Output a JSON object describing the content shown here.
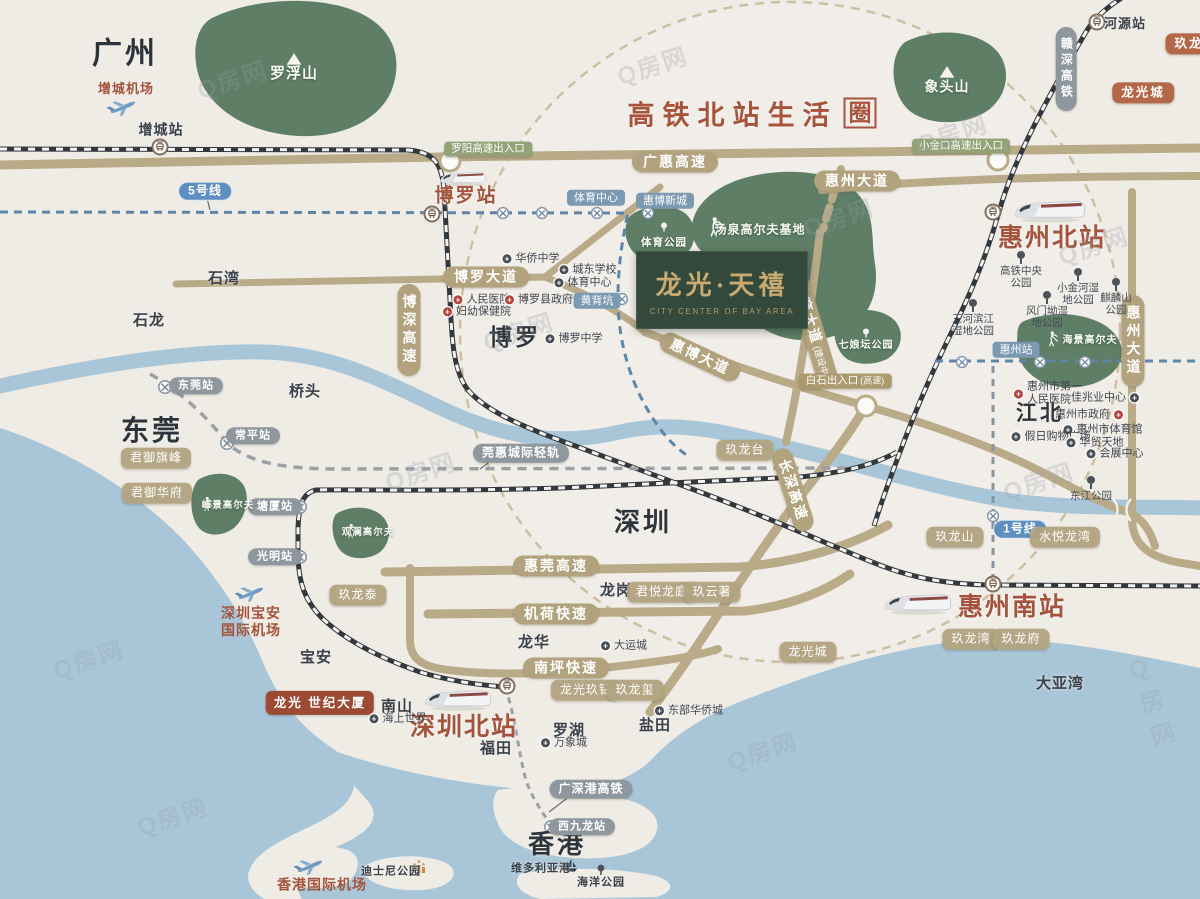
{
  "watermark": {
    "text": "Q房网"
  },
  "title": {
    "main": "高铁北站生活",
    "boxed": "圈"
  },
  "logo": {
    "cn": "龙光·天禧",
    "en": "CITY CENTER OF BAY AREA"
  },
  "colors": {
    "background": "#efece6",
    "water": "#a9c6d8",
    "green_area": "#5e7e66",
    "road": "#b9ab88",
    "railway": "#33383d",
    "metro_line": "#5d86a8",
    "brand_brown": "#a4543c",
    "logo_bg": "#32493c",
    "logo_gold": "#c9ab72",
    "tag_tan": "#b2a37e",
    "tag_orange": "#b4684a",
    "tag_blue": "#7b9ab2",
    "tag_green": "#94a377",
    "tag_darkred": "#9c4a33"
  },
  "labels": [
    {
      "text": "广州",
      "x": 125,
      "y": 55,
      "c": "city",
      "s": 30,
      "n": "city-guangzhou"
    },
    {
      "text": "东莞",
      "x": 152,
      "y": 431,
      "c": "city",
      "s": 28,
      "n": "city-dongguan"
    },
    {
      "text": "深圳",
      "x": 643,
      "y": 523,
      "c": "city",
      "s": 26,
      "n": "city-shenzhen"
    },
    {
      "text": "香港",
      "x": 557,
      "y": 845,
      "c": "city",
      "s": 26,
      "n": "city-hongkong"
    },
    {
      "text": "博罗",
      "x": 515,
      "y": 337,
      "c": "city",
      "s": 23,
      "n": "city-boluo"
    },
    {
      "text": "江北",
      "x": 1040,
      "y": 414,
      "c": "city",
      "s": 21,
      "n": "district-jiangbei"
    },
    {
      "text": "石湾",
      "x": 224,
      "y": 279,
      "c": "dark",
      "s": 15,
      "n": "town-shiwan"
    },
    {
      "text": "石龙",
      "x": 149,
      "y": 321,
      "c": "dark",
      "s": 15,
      "n": "town-shilong"
    },
    {
      "text": "桥头",
      "x": 305,
      "y": 392,
      "c": "dark",
      "s": 15,
      "n": "town-qiaotou"
    },
    {
      "text": "龙岗",
      "x": 616,
      "y": 591,
      "c": "dark",
      "s": 15,
      "n": "district-longgang"
    },
    {
      "text": "龙华",
      "x": 534,
      "y": 643,
      "c": "dark",
      "s": 15,
      "n": "district-longhua"
    },
    {
      "text": "罗湖",
      "x": 569,
      "y": 731,
      "c": "dark",
      "s": 15,
      "n": "district-luohu"
    },
    {
      "text": "盐田",
      "x": 655,
      "y": 726,
      "c": "dark",
      "s": 15,
      "n": "district-yantian"
    },
    {
      "text": "福田",
      "x": 496,
      "y": 749,
      "c": "dark",
      "s": 15,
      "n": "district-futian"
    },
    {
      "text": "南山",
      "x": 397,
      "y": 707,
      "c": "dark",
      "s": 15,
      "n": "district-nanshan"
    },
    {
      "text": "宝安",
      "x": 316,
      "y": 658,
      "c": "dark",
      "s": 15,
      "n": "district-baoan"
    },
    {
      "text": "大亚湾",
      "x": 1060,
      "y": 684,
      "c": "dark",
      "s": 15,
      "n": "bay-dayawan"
    },
    {
      "text": "增城站",
      "x": 161,
      "y": 130,
      "c": "dark",
      "s": 14,
      "n": "station-zengcheng"
    },
    {
      "text": "河源站",
      "x": 1125,
      "y": 24,
      "c": "dark",
      "s": 13,
      "n": "station-heyuan"
    },
    {
      "text": "博罗站",
      "x": 466,
      "y": 196,
      "c": "stbrown",
      "s": 19,
      "n": "station-boluo"
    },
    {
      "text": "惠州北站",
      "x": 1052,
      "y": 238,
      "c": "stbrown",
      "s": 25,
      "n": "station-huizhou-north"
    },
    {
      "text": "惠州南站",
      "x": 1012,
      "y": 607,
      "c": "stbrown",
      "s": 25,
      "n": "station-huizhou-south"
    },
    {
      "text": "深圳北站",
      "x": 464,
      "y": 727,
      "c": "stbrown",
      "s": 25,
      "n": "station-shenzhen-north"
    },
    {
      "text": "增城机场",
      "x": 126,
      "y": 89,
      "c": "airport",
      "s": 13,
      "n": "airport-zengcheng"
    },
    {
      "text": "深圳宝安\n国际机场",
      "x": 251,
      "y": 622,
      "c": "airport",
      "s": 14,
      "n": "airport-baoan"
    },
    {
      "text": "香港国际机场",
      "x": 322,
      "y": 885,
      "c": "airport",
      "s": 14,
      "n": "airport-hongkong"
    },
    {
      "text": "广惠高速",
      "x": 675,
      "y": 162,
      "c": "cap captan",
      "n": "road-guanghui-expressway"
    },
    {
      "text": "惠州大道",
      "x": 857,
      "y": 181,
      "c": "cap captan",
      "n": "road-huizhou-avenue"
    },
    {
      "text": "博罗大道",
      "x": 486,
      "y": 277,
      "c": "cap captan",
      "n": "road-boluo-avenue"
    },
    {
      "text": "惠博大道",
      "x": 700,
      "y": 357,
      "c": "cap captan",
      "r": 25,
      "n": "road-huibo-avenue"
    },
    {
      "text": "长深高速",
      "x": 793,
      "y": 490,
      "c": "cap captan",
      "r": 72,
      "n": "road-changshen-expressway"
    },
    {
      "text": "惠莞高速",
      "x": 556,
      "y": 566,
      "c": "cap captan",
      "n": "road-huiguan-expressway"
    },
    {
      "text": "机荷快速",
      "x": 556,
      "y": 614,
      "c": "cap captan",
      "n": "road-jihe-expressway"
    },
    {
      "text": "南坪快速",
      "x": 566,
      "y": 668,
      "c": "cap captan",
      "n": "road-nanping-expressway"
    },
    {
      "text": "博深高速",
      "x": 409,
      "y": 330,
      "c": "cap captan",
      "v": 1,
      "n": "road-boshen-expressway"
    },
    {
      "text": "惠州大道",
      "x": 1133,
      "y": 341,
      "c": "cap captan",
      "v": 1,
      "n": "road-huizhou-avenue-south"
    },
    {
      "text": "体育大道",
      "sub": "(建设中)",
      "x": 813,
      "y": 330,
      "c": "cap captan",
      "r": 73,
      "n": "road-tiyu-avenue"
    },
    {
      "text": "赣深高铁",
      "x": 1066,
      "y": 69,
      "c": "cap capgray",
      "v": 1,
      "n": "rail-ganshen-hsr"
    },
    {
      "text": "广深港高铁",
      "x": 591,
      "y": 789,
      "c": "cap capgray",
      "n": "rail-guangshengang-hsr"
    },
    {
      "text": "莞惠城际轻轨",
      "x": 521,
      "y": 453,
      "c": "cap capgray",
      "n": "rail-guanhui-intercity"
    },
    {
      "text": "东莞站",
      "x": 196,
      "y": 386,
      "c": "cap capgray",
      "s": 11,
      "n": "station-dongguan"
    },
    {
      "text": "常平站",
      "x": 253,
      "y": 436,
      "c": "cap capgray",
      "s": 11,
      "n": "station-changping"
    },
    {
      "text": "塘厦站",
      "x": 275,
      "y": 507,
      "c": "cap capgray",
      "s": 11,
      "n": "station-tangxia"
    },
    {
      "text": "光明站",
      "x": 275,
      "y": 557,
      "c": "cap capgray",
      "s": 11,
      "n": "station-guangming"
    },
    {
      "text": "西九龙站",
      "x": 582,
      "y": 827,
      "c": "cap capgray",
      "s": 11,
      "n": "station-west-kowloon"
    },
    {
      "text": "体育中心",
      "x": 596,
      "y": 198,
      "c": "bluetag",
      "n": "metro-tiyu-center"
    },
    {
      "text": "惠博新城",
      "x": 665,
      "y": 201,
      "c": "bluetag",
      "n": "metro-huibo-newtown"
    },
    {
      "text": "黄背坑",
      "x": 597,
      "y": 301,
      "c": "bluetag",
      "n": "metro-huangbeikeng"
    },
    {
      "text": "惠州站",
      "x": 1016,
      "y": 350,
      "c": "bluetag",
      "n": "metro-huizhou-station"
    },
    {
      "text": "5号线",
      "x": 205,
      "y": 191,
      "c": "bub",
      "n": "metro-line5-badge"
    },
    {
      "text": "1号线",
      "x": 1020,
      "y": 529,
      "c": "bub",
      "n": "metro-line1-badge"
    },
    {
      "text": "罗阳高速出入口",
      "x": 488,
      "y": 149,
      "c": "cap capgreen",
      "n": "exit-luoyang"
    },
    {
      "text": "小金口高速出入口",
      "x": 961,
      "y": 146,
      "c": "cap capgreen",
      "n": "exit-xiaojinkou"
    },
    {
      "text": "白石出入口",
      "sub": "(高速)",
      "x": 845,
      "y": 381,
      "c": "cap captanentr",
      "n": "exit-baishi"
    },
    {
      "text": "君御旗峰",
      "x": 156,
      "y": 458,
      "c": "cap captag",
      "n": "project-junyu-qifeng"
    },
    {
      "text": "君御华府",
      "x": 157,
      "y": 493,
      "c": "cap captag",
      "n": "project-junyu-huafu"
    },
    {
      "text": "玖龙台",
      "x": 745,
      "y": 450,
      "c": "cap captag",
      "n": "project-jiulongtai"
    },
    {
      "text": "玖龙泰",
      "x": 358,
      "y": 595,
      "c": "cap captag",
      "n": "project-jiulongtai-sz"
    },
    {
      "text": "君悦龙庭",
      "x": 662,
      "y": 592,
      "c": "cap captag",
      "n": "project-junyue-longting"
    },
    {
      "text": "玖云著",
      "x": 712,
      "y": 592,
      "c": "cap captag",
      "n": "project-jiuyunzhu"
    },
    {
      "text": "龙光玖钻",
      "x": 586,
      "y": 690,
      "c": "cap captag",
      "n": "project-jiuzuan"
    },
    {
      "text": "玖龙玺",
      "x": 635,
      "y": 690,
      "c": "cap captag",
      "n": "project-jiulongxi"
    },
    {
      "text": "玖龙山",
      "x": 955,
      "y": 537,
      "c": "cap captag",
      "n": "project-jiulongshan"
    },
    {
      "text": "水悦龙湾",
      "x": 1065,
      "y": 537,
      "c": "cap captag",
      "n": "project-shuiyue-longwan"
    },
    {
      "text": "玖龙湾",
      "x": 971,
      "y": 639,
      "c": "cap captag",
      "n": "project-jiulongwan"
    },
    {
      "text": "玖龙府",
      "x": 1021,
      "y": 639,
      "c": "cap captag",
      "n": "project-jiulongfu"
    },
    {
      "text": "龙光城",
      "x": 808,
      "y": 652,
      "c": "cap captag",
      "n": "project-longguangcheng-south"
    },
    {
      "text": "龙光城",
      "x": 1143,
      "y": 93,
      "c": "cap caporange",
      "n": "project-longguangcheng-north"
    },
    {
      "text": "玖龙",
      "x": 1189,
      "y": 44,
      "c": "cap caporange",
      "n": "project-jiulong-clipped"
    },
    {
      "text": "龙光\n世纪大厦",
      "x": 320,
      "y": 703,
      "c": "cap capdarkred",
      "n": "project-century-tower"
    },
    {
      "text": "罗浮山",
      "x": 294,
      "y": 74,
      "c": "whitelb",
      "s": 15,
      "n": "mountain-luofushan"
    },
    {
      "text": "象头山",
      "x": 947,
      "y": 87,
      "c": "whitelb",
      "s": 14,
      "n": "mountain-xiangtoushan"
    },
    {
      "text": "汤泉高尔夫基地",
      "x": 760,
      "y": 230,
      "c": "whitelb",
      "s": 12,
      "n": "golf-tangquan"
    },
    {
      "text": "体育公园",
      "x": 664,
      "y": 243,
      "c": "whitelb",
      "s": 10.5,
      "n": "park-sports"
    },
    {
      "text": "七娘坛公园",
      "x": 866,
      "y": 346,
      "c": "whitelb",
      "s": 10,
      "n": "park-qiniangtan"
    },
    {
      "text": "海景高尔夫",
      "x": 1090,
      "y": 341,
      "c": "whitelb",
      "s": 10,
      "n": "golf-haijing"
    },
    {
      "text": "峰景高尔夫",
      "x": 228,
      "y": 506,
      "c": "whitelb",
      "s": 9.5,
      "n": "golf-fengjing"
    },
    {
      "text": "观澜高尔夫",
      "x": 368,
      "y": 533,
      "c": "whitelb",
      "s": 9.5,
      "n": "golf-guanlan"
    },
    {
      "text": "华侨中学",
      "x": 531,
      "y": 259,
      "c": "poi",
      "n": "poi-huaqiao-school"
    },
    {
      "text": "城东学校",
      "x": 588,
      "y": 270,
      "c": "poi",
      "n": "poi-chengdong-school"
    },
    {
      "text": "体育中心",
      "x": 583,
      "y": 283,
      "c": "poi",
      "n": "poi-sports-center"
    },
    {
      "text": "人民医院",
      "x": 482,
      "y": 300,
      "c": "poired",
      "n": "poi-renmin-hospital"
    },
    {
      "text": "博罗县政府",
      "x": 539,
      "y": 300,
      "c": "poired",
      "n": "poi-boluo-gov"
    },
    {
      "text": "妇幼保健院",
      "x": 477,
      "y": 312,
      "c": "poired",
      "n": "poi-fuyou-hospital"
    },
    {
      "text": "博罗中学",
      "x": 574,
      "y": 339,
      "c": "poi",
      "n": "poi-boluo-school"
    },
    {
      "text": "大运城",
      "x": 624,
      "y": 646,
      "c": "poi",
      "n": "poi-dayuncheng"
    },
    {
      "text": "东部华侨城",
      "x": 689,
      "y": 711,
      "c": "poi",
      "n": "poi-oct-east"
    },
    {
      "text": "万象城",
      "x": 564,
      "y": 743,
      "c": "poi",
      "n": "poi-mixc"
    },
    {
      "text": "海上世界",
      "x": 398,
      "y": 719,
      "c": "poi",
      "n": "poi-sea-world"
    },
    {
      "text": "惠州市第一\n人民医院",
      "x": 1048,
      "y": 394,
      "c": "poired",
      "n": "poi-huizhou-first-hospital"
    },
    {
      "text": "佳兆业中心",
      "x": 1105,
      "y": 398,
      "c": "poi",
      "side": "r",
      "n": "poi-kaisa-center"
    },
    {
      "text": "惠州市政府",
      "x": 1089,
      "y": 415,
      "c": "poired",
      "side": "r",
      "n": "poi-huizhou-gov"
    },
    {
      "text": "惠州市体育馆",
      "x": 1103,
      "y": 430,
      "c": "poi",
      "n": "poi-huizhou-gym"
    },
    {
      "text": "假日购物广场",
      "x": 1051,
      "y": 437,
      "c": "poi",
      "n": "poi-holiday-plaza"
    },
    {
      "text": "华贸天地",
      "x": 1095,
      "y": 443,
      "c": "poi",
      "n": "poi-huamao"
    },
    {
      "text": "会展中心",
      "x": 1115,
      "y": 454,
      "c": "poi",
      "n": "poi-convention-center"
    },
    {
      "text": "维多利亚港",
      "x": 541,
      "y": 869,
      "c": "dark",
      "s": 11,
      "n": "poi-victoria-harbour"
    },
    {
      "text": "迪士尼公园",
      "x": 391,
      "y": 872,
      "c": "dark",
      "s": 11,
      "n": "poi-disney-park"
    },
    {
      "text": "海洋公园",
      "x": 601,
      "y": 883,
      "c": "dark",
      "s": 11,
      "n": "poi-ocean-park"
    },
    {
      "text": "东江公园",
      "x": 1091,
      "y": 489,
      "c": "park",
      "n": "park-dongjiang"
    },
    {
      "text": "高铁中央公园",
      "x": 1021,
      "y": 270,
      "c": "park",
      "w": 48,
      "n": "park-hsr-central"
    },
    {
      "text": "小金河湿地公园",
      "x": 1078,
      "y": 287,
      "c": "park",
      "w": 46,
      "n": "park-xiaojinhe"
    },
    {
      "text": "麒麟山公园",
      "x": 1116,
      "y": 297,
      "c": "park",
      "w": 36,
      "n": "park-qilinshan"
    },
    {
      "text": "风门坳湿地公园",
      "x": 1047,
      "y": 310,
      "c": "park",
      "w": 46,
      "n": "park-fengmenao"
    },
    {
      "text": "三河滨江湿地公园",
      "x": 973,
      "y": 318,
      "c": "park",
      "w": 48,
      "n": "park-sanhe-binjiang"
    }
  ],
  "icons": [
    {
      "k": "rail-station",
      "x": 160,
      "y": 147
    },
    {
      "k": "rail-station",
      "x": 432,
      "y": 214
    },
    {
      "k": "rail-station",
      "x": 1097,
      "y": 22
    },
    {
      "k": "rail-station",
      "x": 993,
      "y": 212
    },
    {
      "k": "rail-station",
      "x": 993,
      "y": 584
    },
    {
      "k": "rail-station",
      "x": 507,
      "y": 686
    },
    {
      "k": "metro-station",
      "x": 165,
      "y": 387
    },
    {
      "k": "metro-station",
      "x": 227,
      "y": 443
    },
    {
      "k": "metro-station",
      "x": 300,
      "y": 507
    },
    {
      "k": "metro-station",
      "x": 300,
      "y": 557
    },
    {
      "k": "metro-station",
      "x": 551,
      "y": 827
    },
    {
      "k": "metro-stop",
      "x": 503,
      "y": 213
    },
    {
      "k": "metro-stop",
      "x": 542,
      "y": 213
    },
    {
      "k": "metro-stop",
      "x": 597,
      "y": 213
    },
    {
      "k": "metro-stop",
      "x": 648,
      "y": 213
    },
    {
      "k": "metro-stop",
      "x": 622,
      "y": 299
    },
    {
      "k": "metro-stop",
      "x": 962,
      "y": 362
    },
    {
      "k": "metro-stop",
      "x": 1040,
      "y": 362
    },
    {
      "k": "metro-stop",
      "x": 1085,
      "y": 362
    },
    {
      "k": "metro-stop",
      "x": 993,
      "y": 516
    },
    {
      "k": "junction",
      "x": 450,
      "y": 161
    },
    {
      "k": "junction",
      "x": 998,
      "y": 160
    },
    {
      "k": "junction",
      "x": 866,
      "y": 406
    },
    {
      "k": "train",
      "x": 463,
      "y": 178,
      "s": 0.72
    },
    {
      "k": "train",
      "x": 1050,
      "y": 210,
      "s": 1.12
    },
    {
      "k": "train",
      "x": 918,
      "y": 603,
      "s": 1.05
    },
    {
      "k": "train",
      "x": 458,
      "y": 699,
      "s": 1.05
    },
    {
      "k": "plane",
      "x": 121,
      "y": 107
    },
    {
      "k": "plane",
      "x": 249,
      "y": 593
    },
    {
      "k": "plane",
      "x": 308,
      "y": 866
    },
    {
      "k": "golfer",
      "x": 713,
      "y": 227,
      "s": 1.1
    },
    {
      "k": "golfer",
      "x": 206,
      "y": 504,
      "s": 0.8
    },
    {
      "k": "golfer",
      "x": 350,
      "y": 531,
      "s": 0.8
    },
    {
      "k": "golfer",
      "x": 1051,
      "y": 339,
      "s": 0.85
    },
    {
      "k": "mountain",
      "x": 294,
      "y": 59
    },
    {
      "k": "mountain",
      "x": 947,
      "y": 72
    },
    {
      "k": "tree-white",
      "x": 664,
      "y": 228
    },
    {
      "k": "tree-white",
      "x": 866,
      "y": 334
    },
    {
      "k": "tree-dark",
      "x": 601,
      "y": 871
    },
    {
      "k": "boat",
      "x": 571,
      "y": 867
    },
    {
      "k": "castle",
      "x": 419,
      "y": 869
    },
    {
      "k": "bridge",
      "x": 1122,
      "y": 510
    }
  ],
  "watermarks": [
    {
      "x": 232,
      "y": 78
    },
    {
      "x": 652,
      "y": 64
    },
    {
      "x": 838,
      "y": 216
    },
    {
      "x": 1093,
      "y": 244
    },
    {
      "x": 518,
      "y": 330
    },
    {
      "x": 420,
      "y": 470
    },
    {
      "x": 1038,
      "y": 480
    },
    {
      "x": 88,
      "y": 658
    },
    {
      "x": 762,
      "y": 750
    },
    {
      "x": 172,
      "y": 815
    },
    {
      "x": 952,
      "y": 132
    },
    {
      "x": 1160,
      "y": 700
    }
  ]
}
